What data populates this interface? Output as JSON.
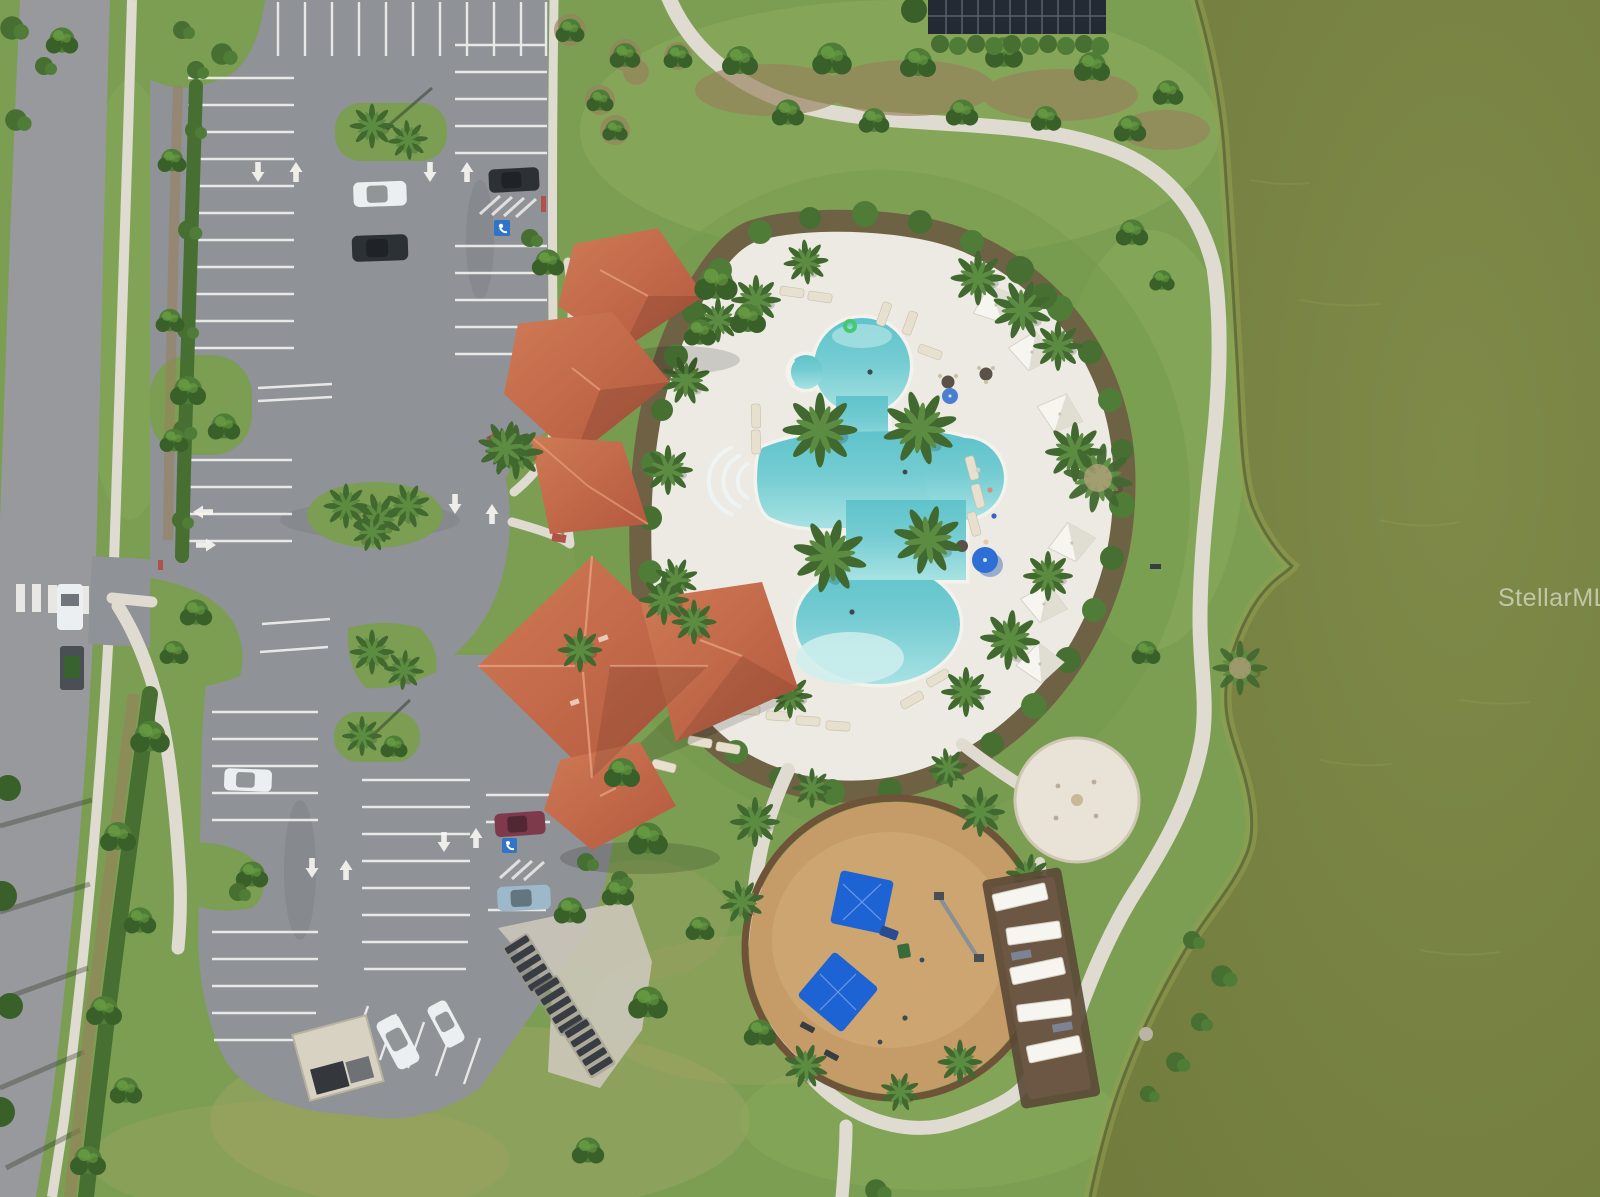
{
  "image": {
    "kind": "aerial-drone-photo",
    "width": 1600,
    "height": 1197,
    "description": "Overhead aerial view of a community amenity center: tile-roof clubhouse, freeform resort pool with cabanas, circular playground, splash pad, picnic shelters, two parking lots with landscaped islands, an access road with crosswalk, curving concrete paths and an algae-green pond on the right."
  },
  "watermark": {
    "text": "StellarMLS"
  },
  "scene": {
    "lake": "algae-green pond occupying right side",
    "pool": "freeform turquoise pool with spa, beach entry and step wedges",
    "pool_deck": "white concrete pool deck ringed by tropical landscaping",
    "cabanas": "six white shade cabanas along east pool deck",
    "umbrellas": "blue pool umbrellas",
    "clubhouse": "clubhouse cluster with terracotta hip roofs",
    "playground": "circular engineered-mulch playground with blue shade canopies",
    "splash_pad": "small round splash pad",
    "shelters": "row of white-top picnic shelters east of playground",
    "parking_upper": "upper parking lot with striped stalls, islands, 3 cars, handicap stall",
    "parking_lower": "lower parking lot with striped stalls, 5 vehicles, dumpster enclosure, bike racks",
    "drop_off_loop": "drop-off loop with palm island and pavement arrows",
    "road": "two-lane access road with crosswalk, work truck and trailer",
    "paths": "white concrete walking paths looping around grounds"
  },
  "colors": {
    "grass": "#7b9e53",
    "grassLight": "#8fae5e",
    "grassDry": "#a2a365",
    "grassDark": "#6f9447",
    "lake": "#717c3d",
    "lakeLight": "#7f8a49",
    "shoreAlgae": "#95a052",
    "shoreRock": "#4f5a30",
    "asphalt": "#8f9296",
    "road": "#97999c",
    "stripe": "#f2f3f0",
    "concrete": "#dfdbd0",
    "deck": "#eceae3",
    "coping": "#f4f2ec",
    "mulch": "#6d5b42",
    "mulchLight": "#98815e",
    "hedge": "#466f31",
    "treeDark": "#3a6029",
    "treeMid": "#4f7d38",
    "treeLight": "#6da344",
    "palmGreen": "#41682f",
    "palmLight": "#5c8c41",
    "palmTan": "#b3a07a",
    "roofLight": "#cf7a55",
    "roofDark": "#b4583e",
    "roofRidge": "#e59d7b",
    "pool": "#74ccd2",
    "poolDeep": "#5fc3cb",
    "poolPale": "#a7e2e3",
    "sand": "#c59c67",
    "sandLight": "#d2ab78",
    "sandRing": "#6e5338",
    "splash": "#e9e2d6",
    "canopyBlue": "#1e63d4",
    "umbBlue": "#2e6fd6",
    "white": "#f7f5f0",
    "tentShade": "#e0ddd2",
    "carDark": "#2c3136",
    "carWhite": "#eceff1",
    "carMaroon": "#7e3a4a",
    "carBlue": "#9db9c9",
    "lounger": "#e7e0cf",
    "dumpster": "#d8d2c2",
    "rack": "#383d43",
    "bldgDark": "#232a33",
    "curbRed": "#b0524a",
    "floatGreen": "#46c96a"
  }
}
